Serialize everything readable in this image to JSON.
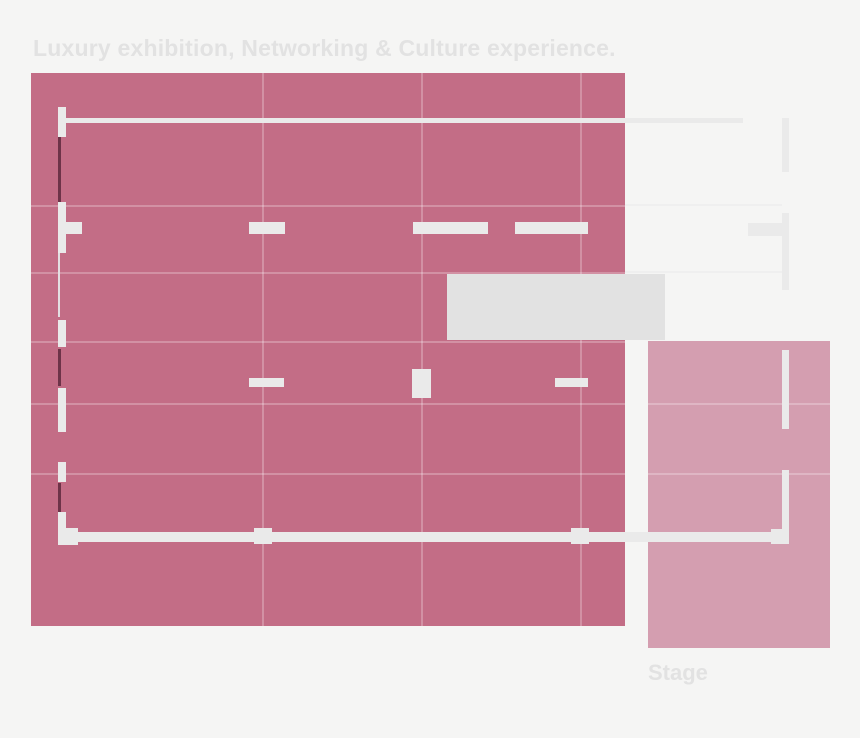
{
  "page": {
    "title": "Luxury exhibition, Networking & Culture experience.",
    "stage_label": "Stage"
  },
  "zones": {
    "hall_name": "exhibition-hall",
    "stage_name": "stage"
  },
  "colors": {
    "background": "#f5f5f4",
    "hall": "#c36d86",
    "hallGrid": "rgba(255,255,255,0.25)",
    "stage": "#d49eb0",
    "wall": "#eaeaea",
    "wallDark": "#6d3348",
    "wallFaint": "#e3dfe2",
    "block": "#e2e2e2",
    "gridExtension": "#efefef",
    "labelText": "#e2e2e2"
  }
}
